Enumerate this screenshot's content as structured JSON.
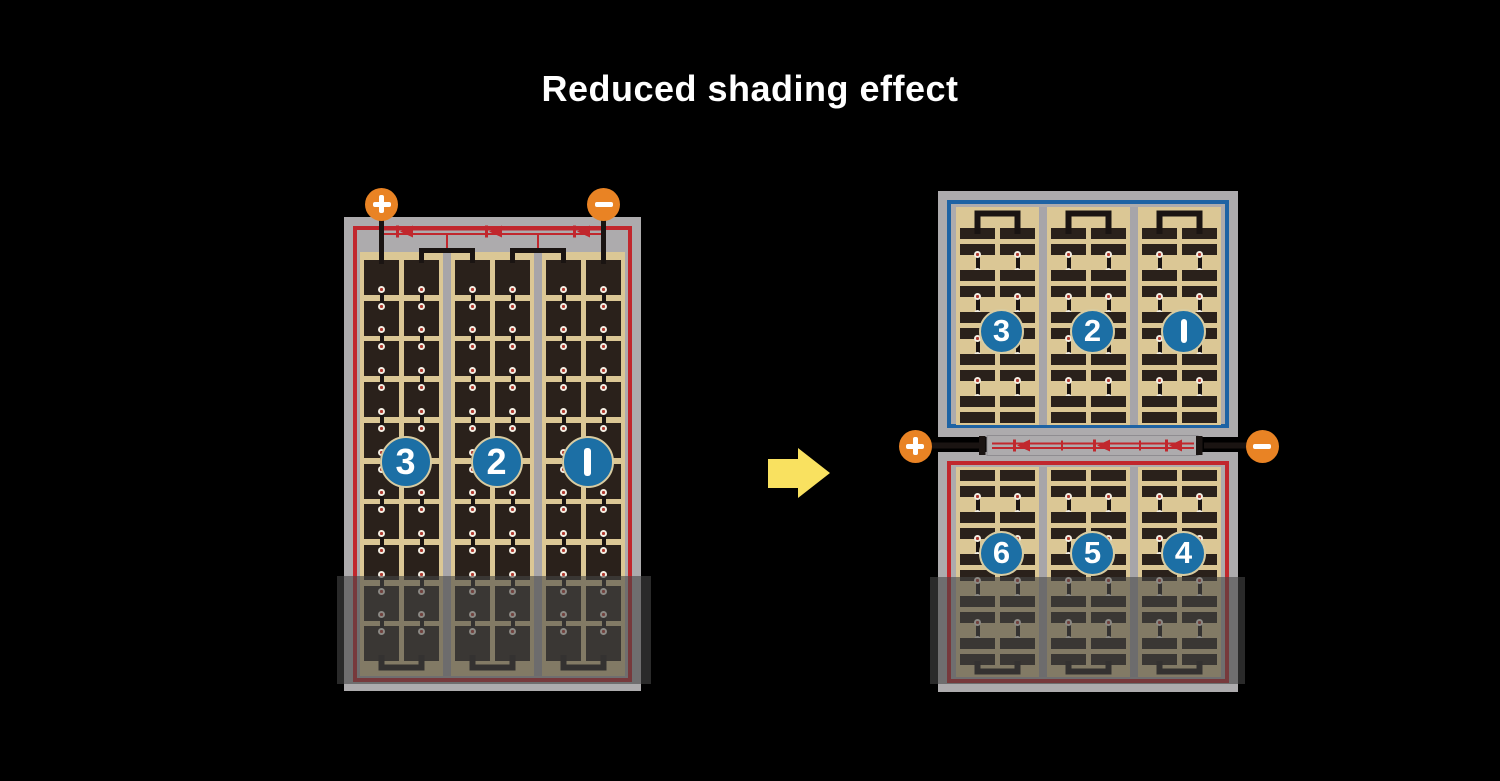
{
  "title": "Reduced shading effect",
  "colors": {
    "background": "#000000",
    "title_text": "#FFFFFF",
    "frame_gray": "#ADABAD",
    "separator_gray": "#A7A5A9",
    "panel_tan": "#DBC795",
    "cell_dark": "#2A211B",
    "wire_black": "#1A1412",
    "circuit_red": "#C1272D",
    "border_blue": "#1E63A4",
    "badge_blue": "#1C6FA5",
    "badge_text": "#FFFFFF",
    "terminal_orange": "#E98324",
    "arrow_yellow": "#F9E160",
    "dot_white": "#F2EDE2",
    "dot_red": "#B03A30",
    "shade": "rgba(70,70,70,0.6)"
  },
  "left_panel": {
    "terminals": [
      {
        "symbol": "+"
      },
      {
        "symbol": "−"
      }
    ],
    "string_badges": [
      "3",
      "2",
      "1"
    ],
    "diode_count": 3
  },
  "right_panel": {
    "terminals": [
      {
        "symbol": "+"
      },
      {
        "symbol": "−"
      }
    ],
    "top_string_badges": [
      "3",
      "2",
      "1"
    ],
    "bottom_string_badges": [
      "6",
      "5",
      "4"
    ],
    "diode_count": 3
  },
  "arrow": {
    "direction": "right"
  }
}
